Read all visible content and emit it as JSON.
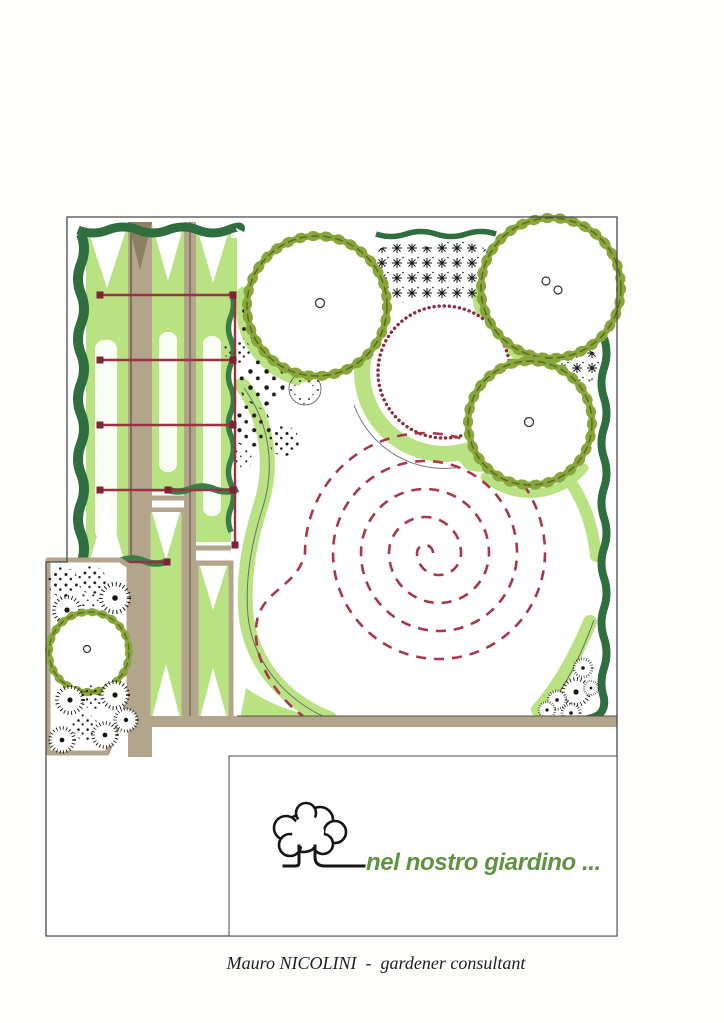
{
  "logo": {
    "text": "nel nostro giardino ...",
    "color": "#5f9340",
    "icon": "tree-logo-icon"
  },
  "footer": {
    "text": "Mauro NICOLINI  -  gardener consultant"
  },
  "palette": {
    "lawn_light_green": "#b9e283",
    "hedge_dark_green": "#2f6e3f",
    "tree_olive": "#8aa63b",
    "path_tan": "#b3a48c",
    "wire_maroon": "#9c3044",
    "spiral_red": "#a7374b",
    "ink": "#4a4a4a"
  },
  "plan_symbols": [
    "scalloped-canopy-tree",
    "dotted-maroon-circle-bed",
    "dashed-spiral-path",
    "wavy-hedge-rows",
    "espalier-wire-lines",
    "stippled-shrub-circles",
    "spiky-shrub-thicket",
    "raised-strip-beds",
    "tan-garden-paths"
  ]
}
